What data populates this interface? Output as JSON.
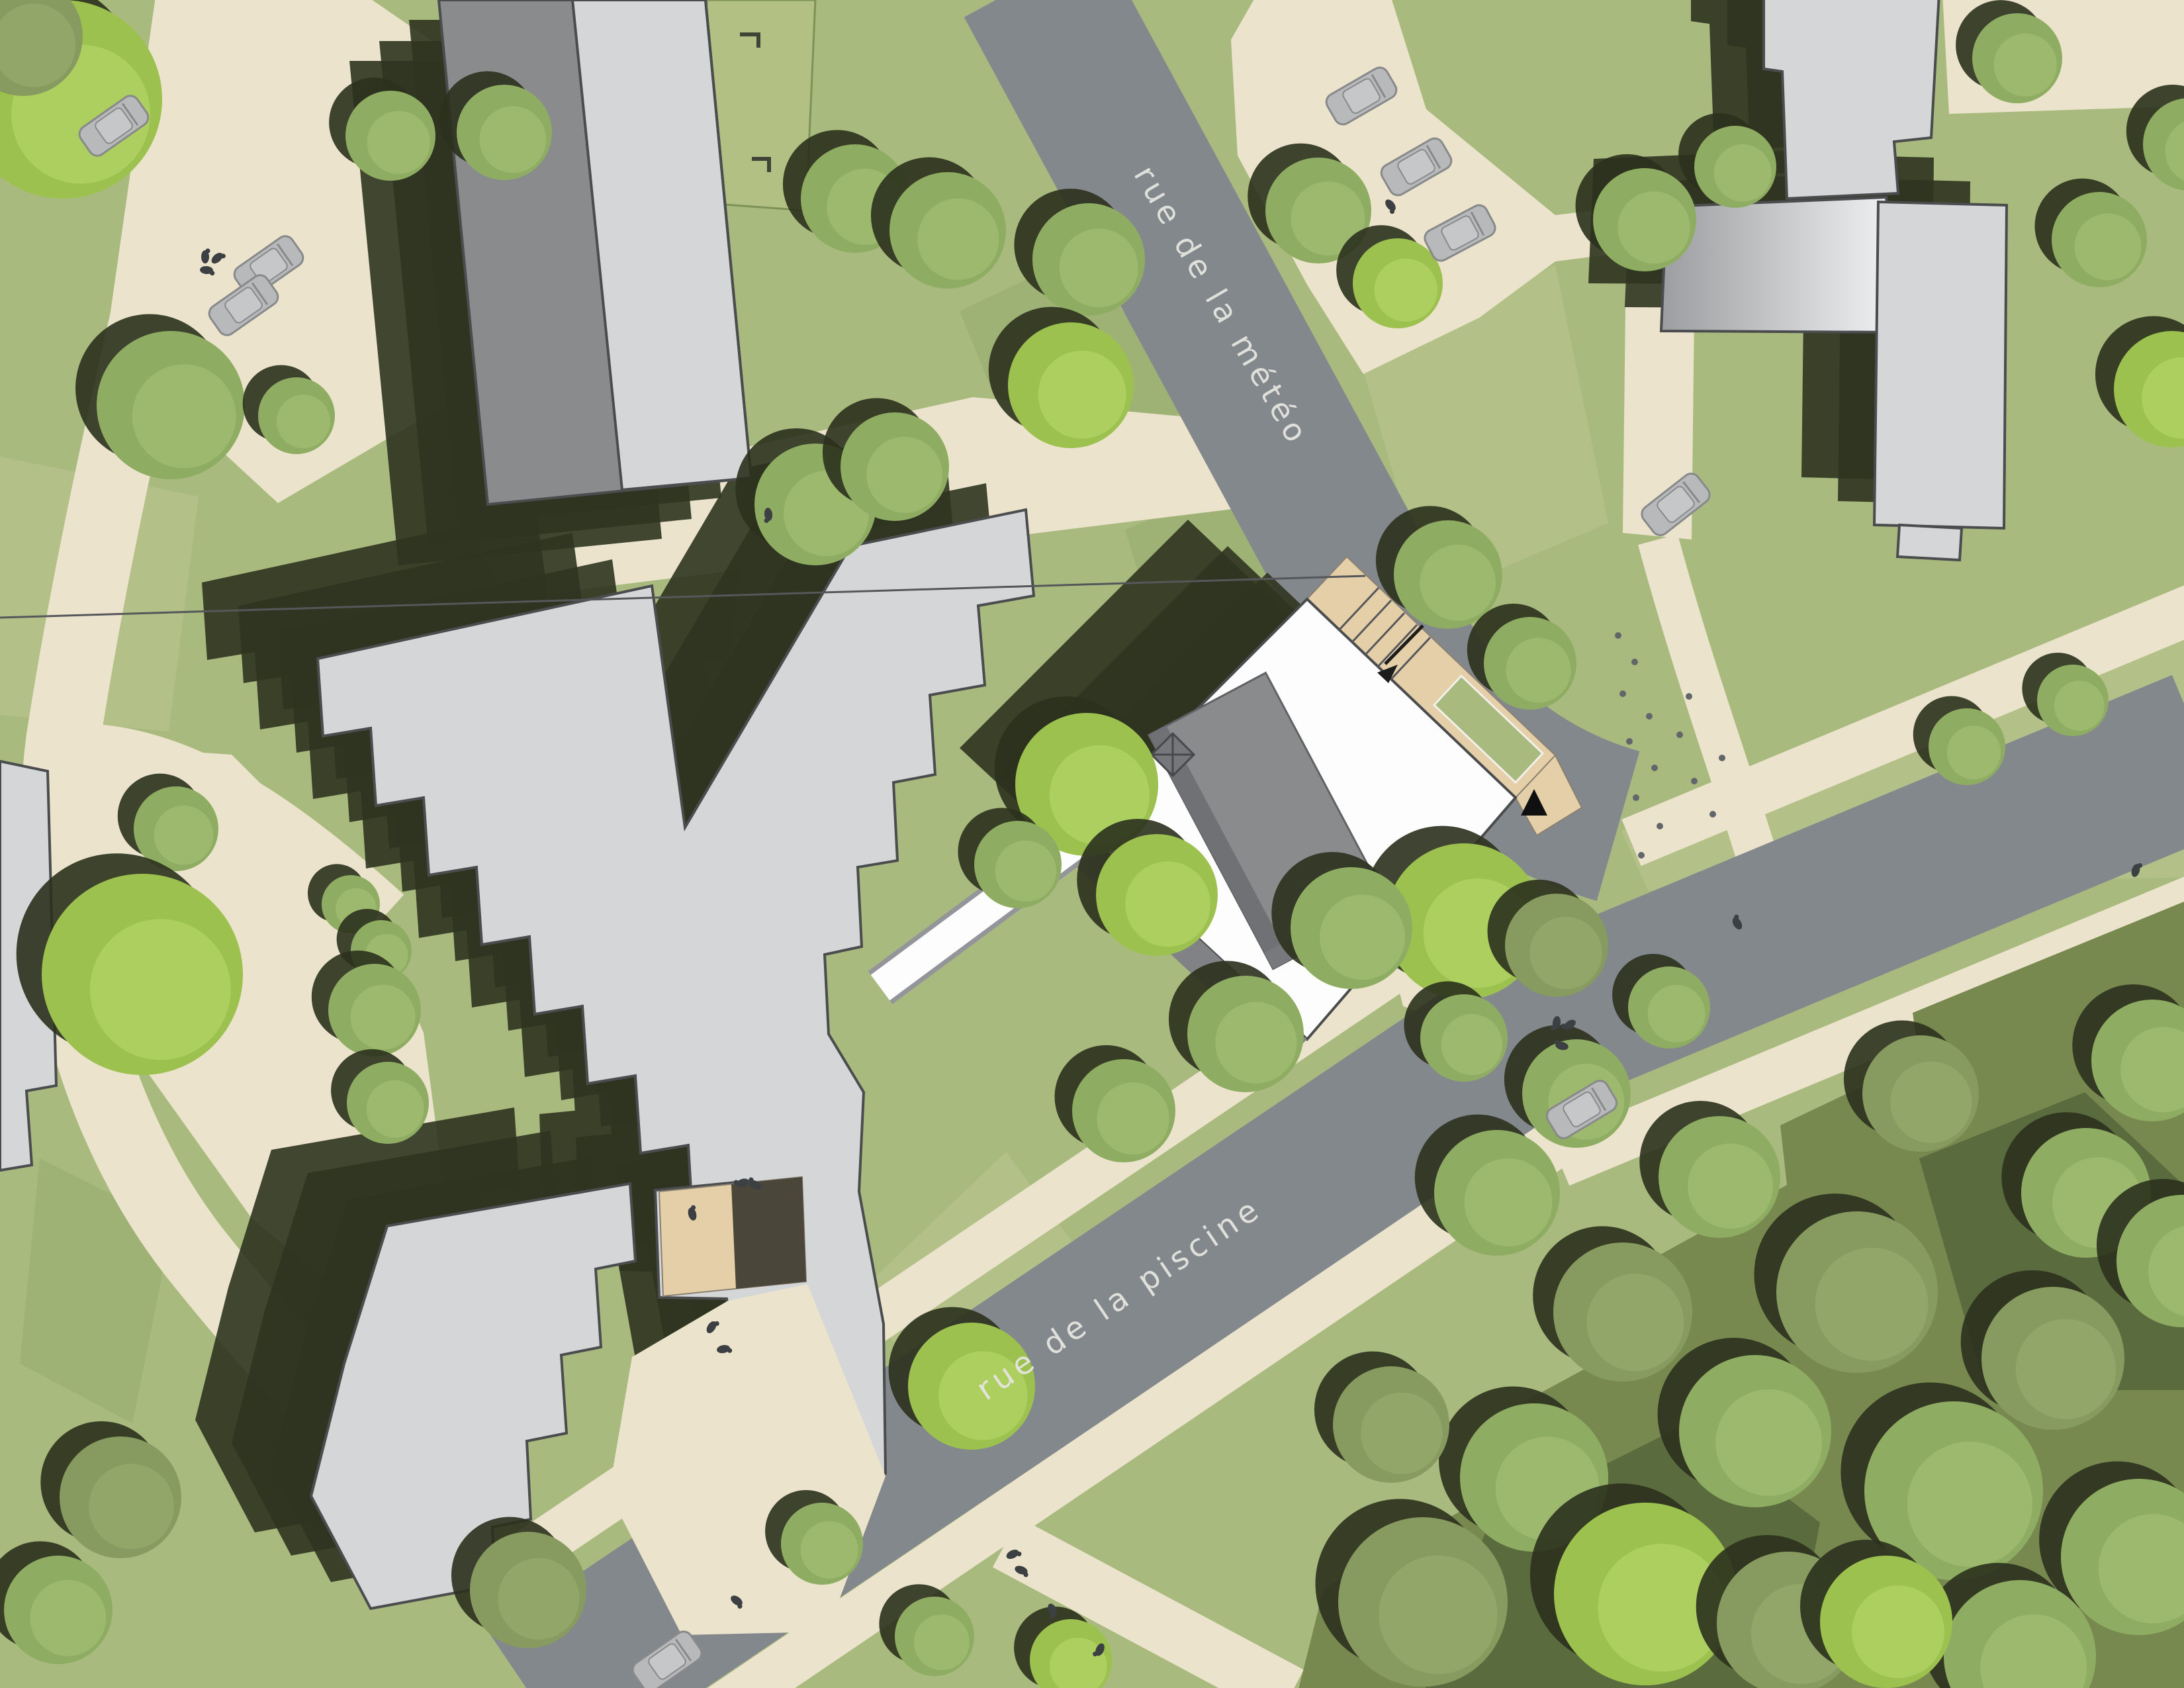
{
  "labels": {
    "street_meteo": "rue de la météo",
    "street_piscine": "rue de la piscine"
  },
  "colors": {
    "grass": "#a9ba7f",
    "grassLight": "#bcc792",
    "grassDark": "#93aa6d",
    "path": "#ece3cc",
    "road": "#83888d",
    "roofLight": "#d5d6d7",
    "roofMid": "#8a8b8d",
    "outline": "#4a4c4e",
    "shadow": "#2f3420",
    "forest": "#77894f",
    "forestDark": "#4c5a36",
    "tan": "#e4cfa9",
    "tanShadow": "#4b463a",
    "white": "#fdfdfd",
    "facade": "#808285",
    "carBody": "#b8b9bb",
    "carCabin": "#c6c7c9",
    "carOutline": "#87898b",
    "person": "#3c4043",
    "dots": "#62666a",
    "label": "#e6e5e0",
    "treeBright": "#9cc14e",
    "treeBrightHl": "#b2d365",
    "treeMid": "#8fad62",
    "treeMidHl": "#a0bd73",
    "treeOlive": "#879a60",
    "treeOliveHl": "#97a96e",
    "treeShadow": "#2b311d",
    "gradA": "#f4f5f6",
    "gradB": "#9b9da0"
  },
  "map_objects": {
    "buildings": [
      {
        "name": "slab-building-north"
      },
      {
        "name": "zigzag-building-upper"
      },
      {
        "name": "zigzag-building-lower"
      },
      {
        "name": "project-building-white"
      },
      {
        "name": "tower-building-northeast"
      },
      {
        "name": "metal-roof-hall-northeast"
      },
      {
        "name": "bar-building-northeast"
      },
      {
        "name": "edge-building-west"
      }
    ],
    "counts": {
      "trees": 67,
      "cars": 9,
      "people": 20,
      "road_dots": 14
    },
    "trees": [
      [
        95,
        150,
        150,
        "bright"
      ],
      [
        35,
        55,
        90,
        "olive"
      ],
      [
        590,
        205,
        68,
        "mid"
      ],
      [
        762,
        200,
        72,
        "mid"
      ],
      [
        258,
        612,
        112,
        "mid"
      ],
      [
        448,
        628,
        58,
        "mid"
      ],
      [
        1292,
        300,
        82,
        "mid"
      ],
      [
        1432,
        348,
        88,
        "mid"
      ],
      [
        1232,
        762,
        92,
        "mid"
      ],
      [
        1352,
        705,
        82,
        "mid"
      ],
      [
        1645,
        392,
        85,
        "mid"
      ],
      [
        1618,
        582,
        95,
        "bright"
      ],
      [
        1992,
        318,
        80,
        "mid"
      ],
      [
        2112,
        428,
        68,
        "bright"
      ],
      [
        2188,
        868,
        82,
        "mid"
      ],
      [
        2312,
        1002,
        70,
        "mid"
      ],
      [
        2485,
        332,
        78,
        "mid"
      ],
      [
        2622,
        252,
        62,
        "mid"
      ],
      [
        3048,
        88,
        68,
        "mid"
      ],
      [
        3172,
        362,
        72,
        "mid"
      ],
      [
        3282,
        588,
        88,
        "bright"
      ],
      [
        3308,
        218,
        70,
        "mid"
      ],
      [
        2212,
        1392,
        118,
        "bright"
      ],
      [
        2352,
        1428,
        78,
        "olive"
      ],
      [
        1642,
        1185,
        108,
        "bright"
      ],
      [
        1538,
        1306,
        66,
        "mid"
      ],
      [
        1748,
        1352,
        92,
        "bright"
      ],
      [
        2042,
        1402,
        92,
        "mid"
      ],
      [
        1882,
        1562,
        88,
        "mid"
      ],
      [
        1698,
        1678,
        78,
        "mid"
      ],
      [
        2972,
        1128,
        58,
        "mid"
      ],
      [
        3132,
        1058,
        54,
        "mid"
      ],
      [
        266,
        1252,
        64,
        "mid"
      ],
      [
        215,
        1472,
        152,
        "bright"
      ],
      [
        530,
        1366,
        44,
        "mid"
      ],
      [
        576,
        1436,
        46,
        "mid"
      ],
      [
        566,
        1526,
        70,
        "mid"
      ],
      [
        586,
        1666,
        62,
        "mid"
      ],
      [
        182,
        2262,
        92,
        "olive"
      ],
      [
        88,
        2432,
        82,
        "mid"
      ],
      [
        798,
        2402,
        88,
        "olive"
      ],
      [
        1242,
        2332,
        62,
        "mid"
      ],
      [
        1412,
        2472,
        60,
        "mid"
      ],
      [
        1618,
        2508,
        62,
        "bright"
      ],
      [
        1468,
        2094,
        96,
        "bright"
      ],
      [
        2150,
        2420,
        128,
        "olive"
      ],
      [
        2318,
        2232,
        112,
        "mid"
      ],
      [
        2486,
        2408,
        138,
        "bright"
      ],
      [
        2652,
        2162,
        115,
        "mid"
      ],
      [
        2452,
        1982,
        105,
        "olive"
      ],
      [
        2262,
        1802,
        95,
        "mid"
      ],
      [
        2598,
        1778,
        92,
        "mid"
      ],
      [
        2806,
        1952,
        122,
        "olive"
      ],
      [
        2952,
        2252,
        135,
        "mid"
      ],
      [
        3102,
        2052,
        108,
        "olive"
      ],
      [
        3232,
        2352,
        118,
        "mid"
      ],
      [
        3152,
        1802,
        98,
        "mid"
      ],
      [
        2902,
        1652,
        88,
        "olive"
      ],
      [
        3252,
        1602,
        92,
        "mid"
      ],
      [
        2702,
        2452,
        108,
        "olive"
      ],
      [
        3052,
        2502,
        115,
        "mid"
      ],
      [
        2102,
        2152,
        88,
        "olive"
      ],
      [
        2382,
        1652,
        82,
        "mid"
      ],
      [
        2212,
        1568,
        66,
        "mid"
      ],
      [
        2522,
        1522,
        62,
        "mid"
      ],
      [
        3298,
        1905,
        100,
        "mid"
      ],
      [
        2850,
        2450,
        100,
        "bright"
      ]
    ],
    "cars": [
      [
        172,
        190,
        -35
      ],
      [
        406,
        402,
        -35
      ],
      [
        368,
        461,
        -35
      ],
      [
        2057,
        145,
        -30
      ],
      [
        2140,
        252,
        -30
      ],
      [
        2206,
        352,
        -28
      ],
      [
        2532,
        762,
        -38
      ],
      [
        2390,
        1676,
        -31
      ],
      [
        1008,
        2510,
        -35
      ]
    ],
    "people": [
      [
        310,
        388
      ],
      [
        328,
        390
      ],
      [
        312,
        408
      ],
      [
        2101,
        310
      ],
      [
        2352,
        1545
      ],
      [
        2372,
        1548
      ],
      [
        2360,
        1580
      ],
      [
        2625,
        1395
      ],
      [
        3227,
        1315
      ],
      [
        1530,
        2348
      ],
      [
        1543,
        2372
      ],
      [
        1590,
        2432
      ],
      [
        1662,
        2492
      ],
      [
        1122,
        1787
      ],
      [
        1141,
        1790
      ],
      [
        1046,
        1834
      ],
      [
        1075,
        2005
      ],
      [
        1093,
        2038
      ],
      [
        1113,
        2418
      ],
      [
        1161,
        777
      ]
    ],
    "road_dots": [
      [
        2445,
        960
      ],
      [
        2470,
        1000
      ],
      [
        2452,
        1048
      ],
      [
        2492,
        1082
      ],
      [
        2462,
        1120
      ],
      [
        2500,
        1160
      ],
      [
        2472,
        1205
      ],
      [
        2508,
        1248
      ],
      [
        2480,
        1292
      ],
      [
        2538,
        1110
      ],
      [
        2552,
        1052
      ],
      [
        2560,
        1180
      ],
      [
        2588,
        1230
      ],
      [
        2602,
        1145
      ]
    ]
  }
}
